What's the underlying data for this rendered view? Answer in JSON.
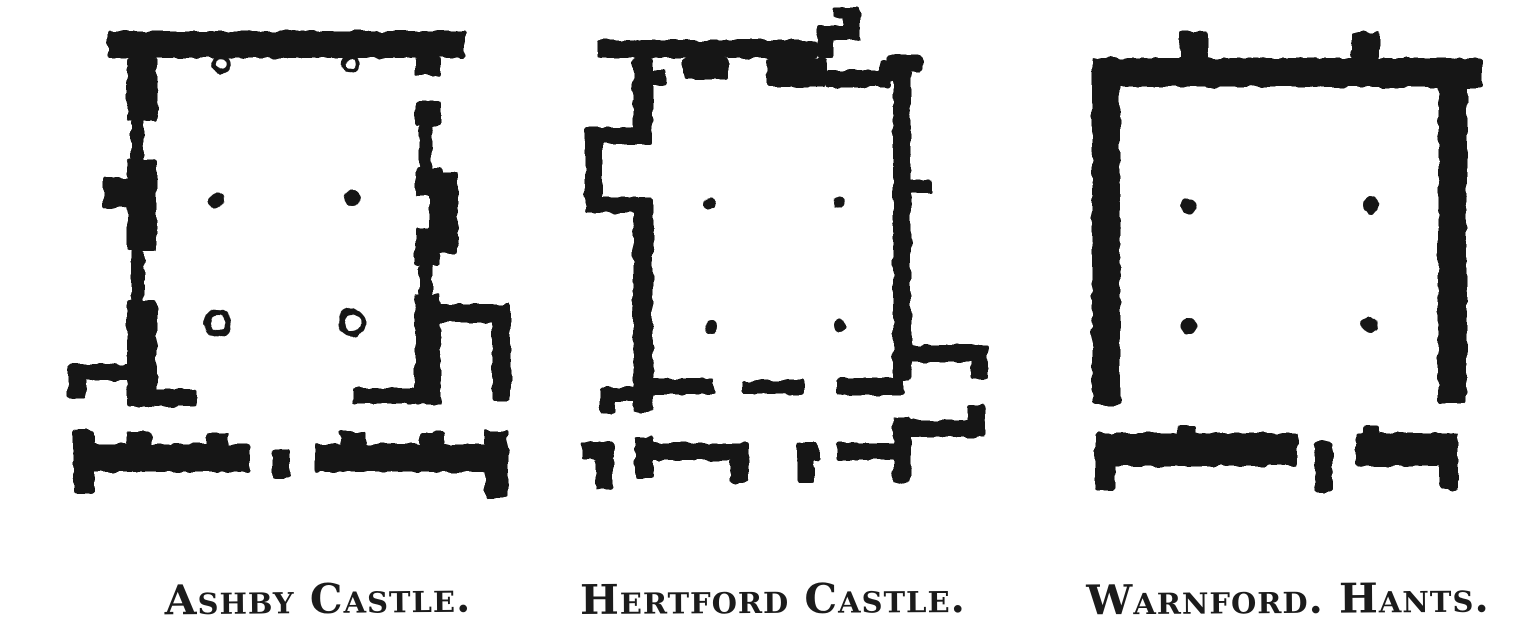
{
  "page": {
    "background": "#ffffff",
    "ink": "#181818"
  },
  "figure": {
    "kind": "scanned plate of three mediaeval hall floor plans",
    "plans": [
      {
        "id": "ashby-castle",
        "label": "Ashby Castle.",
        "walls": [
          [
            108,
            31,
            357,
            27
          ],
          [
            415,
            58,
            26,
            18
          ],
          [
            127,
            58,
            30,
            63
          ],
          [
            131,
            120,
            13,
            41
          ],
          [
            127,
            160,
            30,
            91
          ],
          [
            131,
            250,
            13,
            51
          ],
          [
            127,
            300,
            30,
            107
          ],
          [
            103,
            177,
            25,
            31
          ],
          [
            68,
            364,
            65,
            16
          ],
          [
            68,
            364,
            19,
            34
          ],
          [
            132,
            389,
            65,
            17
          ],
          [
            415,
            100,
            26,
            26
          ],
          [
            419,
            125,
            13,
            43
          ],
          [
            415,
            167,
            26,
            29
          ],
          [
            429,
            172,
            29,
            82
          ],
          [
            415,
            228,
            26,
            37
          ],
          [
            419,
            264,
            13,
            31
          ],
          [
            415,
            294,
            26,
            110
          ],
          [
            430,
            304,
            81,
            19
          ],
          [
            492,
            304,
            19,
            97
          ],
          [
            353,
            388,
            63,
            16
          ],
          [
            73,
            430,
            21,
            64
          ],
          [
            73,
            444,
            177,
            28
          ],
          [
            126,
            431,
            26,
            14
          ],
          [
            205,
            433,
            24,
            12
          ],
          [
            272,
            450,
            17,
            28
          ],
          [
            315,
            444,
            188,
            28
          ],
          [
            340,
            431,
            26,
            14
          ],
          [
            420,
            432,
            25,
            13
          ],
          [
            485,
            430,
            23,
            68
          ]
        ],
        "columns": [
          {
            "x": 216,
            "y": 200,
            "r": 8,
            "open": false
          },
          {
            "x": 353,
            "y": 198,
            "r": 8,
            "open": false
          },
          {
            "x": 218,
            "y": 323,
            "r": 11,
            "open": true
          },
          {
            "x": 352,
            "y": 323,
            "r": 11,
            "open": true
          }
        ],
        "door_marks": [
          {
            "x": 221,
            "y": 64,
            "r": 7
          },
          {
            "x": 351,
            "y": 64,
            "r": 7
          }
        ]
      },
      {
        "id": "hertford-castle",
        "label": "Hertford Castle.",
        "walls": [
          [
            598,
            40,
            219,
            18
          ],
          [
            817,
            25,
            16,
            33
          ],
          [
            817,
            25,
            43,
            15
          ],
          [
            844,
            7,
            16,
            33
          ],
          [
            833,
            7,
            27,
            12
          ],
          [
            767,
            58,
            60,
            29
          ],
          [
            827,
            70,
            63,
            17
          ],
          [
            683,
            58,
            45,
            21
          ],
          [
            633,
            58,
            20,
            86
          ],
          [
            650,
            70,
            17,
            15
          ],
          [
            587,
            127,
            63,
            17
          ],
          [
            585,
            127,
            17,
            86
          ],
          [
            585,
            197,
            66,
            16
          ],
          [
            633,
            197,
            20,
            215
          ],
          [
            600,
            387,
            43,
            15
          ],
          [
            600,
            387,
            15,
            27
          ],
          [
            888,
            55,
            35,
            17
          ],
          [
            880,
            60,
            15,
            21
          ],
          [
            893,
            58,
            18,
            322
          ],
          [
            910,
            179,
            22,
            14
          ],
          [
            893,
            417,
            18,
            66
          ],
          [
            898,
            345,
            90,
            17
          ],
          [
            971,
            360,
            17,
            19
          ],
          [
            898,
            420,
            87,
            17
          ],
          [
            968,
            404,
            17,
            18
          ],
          [
            642,
            378,
            72,
            17
          ],
          [
            742,
            380,
            62,
            14
          ],
          [
            837,
            378,
            67,
            17
          ],
          [
            582,
            442,
            32,
            17
          ],
          [
            596,
            458,
            17,
            32
          ],
          [
            635,
            437,
            18,
            41
          ],
          [
            635,
            443,
            113,
            17
          ],
          [
            730,
            458,
            18,
            25
          ],
          [
            797,
            443,
            22,
            17
          ],
          [
            797,
            458,
            17,
            25
          ],
          [
            837,
            443,
            67,
            17
          ]
        ],
        "columns": [
          {
            "x": 710,
            "y": 204,
            "r": 6,
            "open": false
          },
          {
            "x": 839,
            "y": 203,
            "r": 6,
            "open": false
          },
          {
            "x": 711,
            "y": 327,
            "r": 6,
            "open": false
          },
          {
            "x": 840,
            "y": 326,
            "r": 6,
            "open": false
          }
        ],
        "door_marks": []
      },
      {
        "id": "warnford-hants",
        "label": "Warnford. Hants.",
        "walls": [
          [
            1092,
            58,
            390,
            29
          ],
          [
            1180,
            32,
            28,
            28
          ],
          [
            1352,
            32,
            27,
            28
          ],
          [
            1460,
            64,
            22,
            24
          ],
          [
            1092,
            58,
            28,
            347
          ],
          [
            1438,
            58,
            29,
            346
          ],
          [
            1095,
            433,
            20,
            57
          ],
          [
            1095,
            433,
            202,
            33
          ],
          [
            1177,
            426,
            18,
            9
          ],
          [
            1315,
            442,
            17,
            50
          ],
          [
            1355,
            433,
            103,
            33
          ],
          [
            1362,
            426,
            18,
            9
          ],
          [
            1439,
            433,
            19,
            57
          ]
        ],
        "columns": [
          {
            "x": 1189,
            "y": 207,
            "r": 8,
            "open": false
          },
          {
            "x": 1371,
            "y": 205,
            "r": 8,
            "open": false
          },
          {
            "x": 1189,
            "y": 326,
            "r": 8,
            "open": false
          },
          {
            "x": 1370,
            "y": 325,
            "r": 8,
            "open": false
          }
        ],
        "door_marks": []
      }
    ]
  }
}
